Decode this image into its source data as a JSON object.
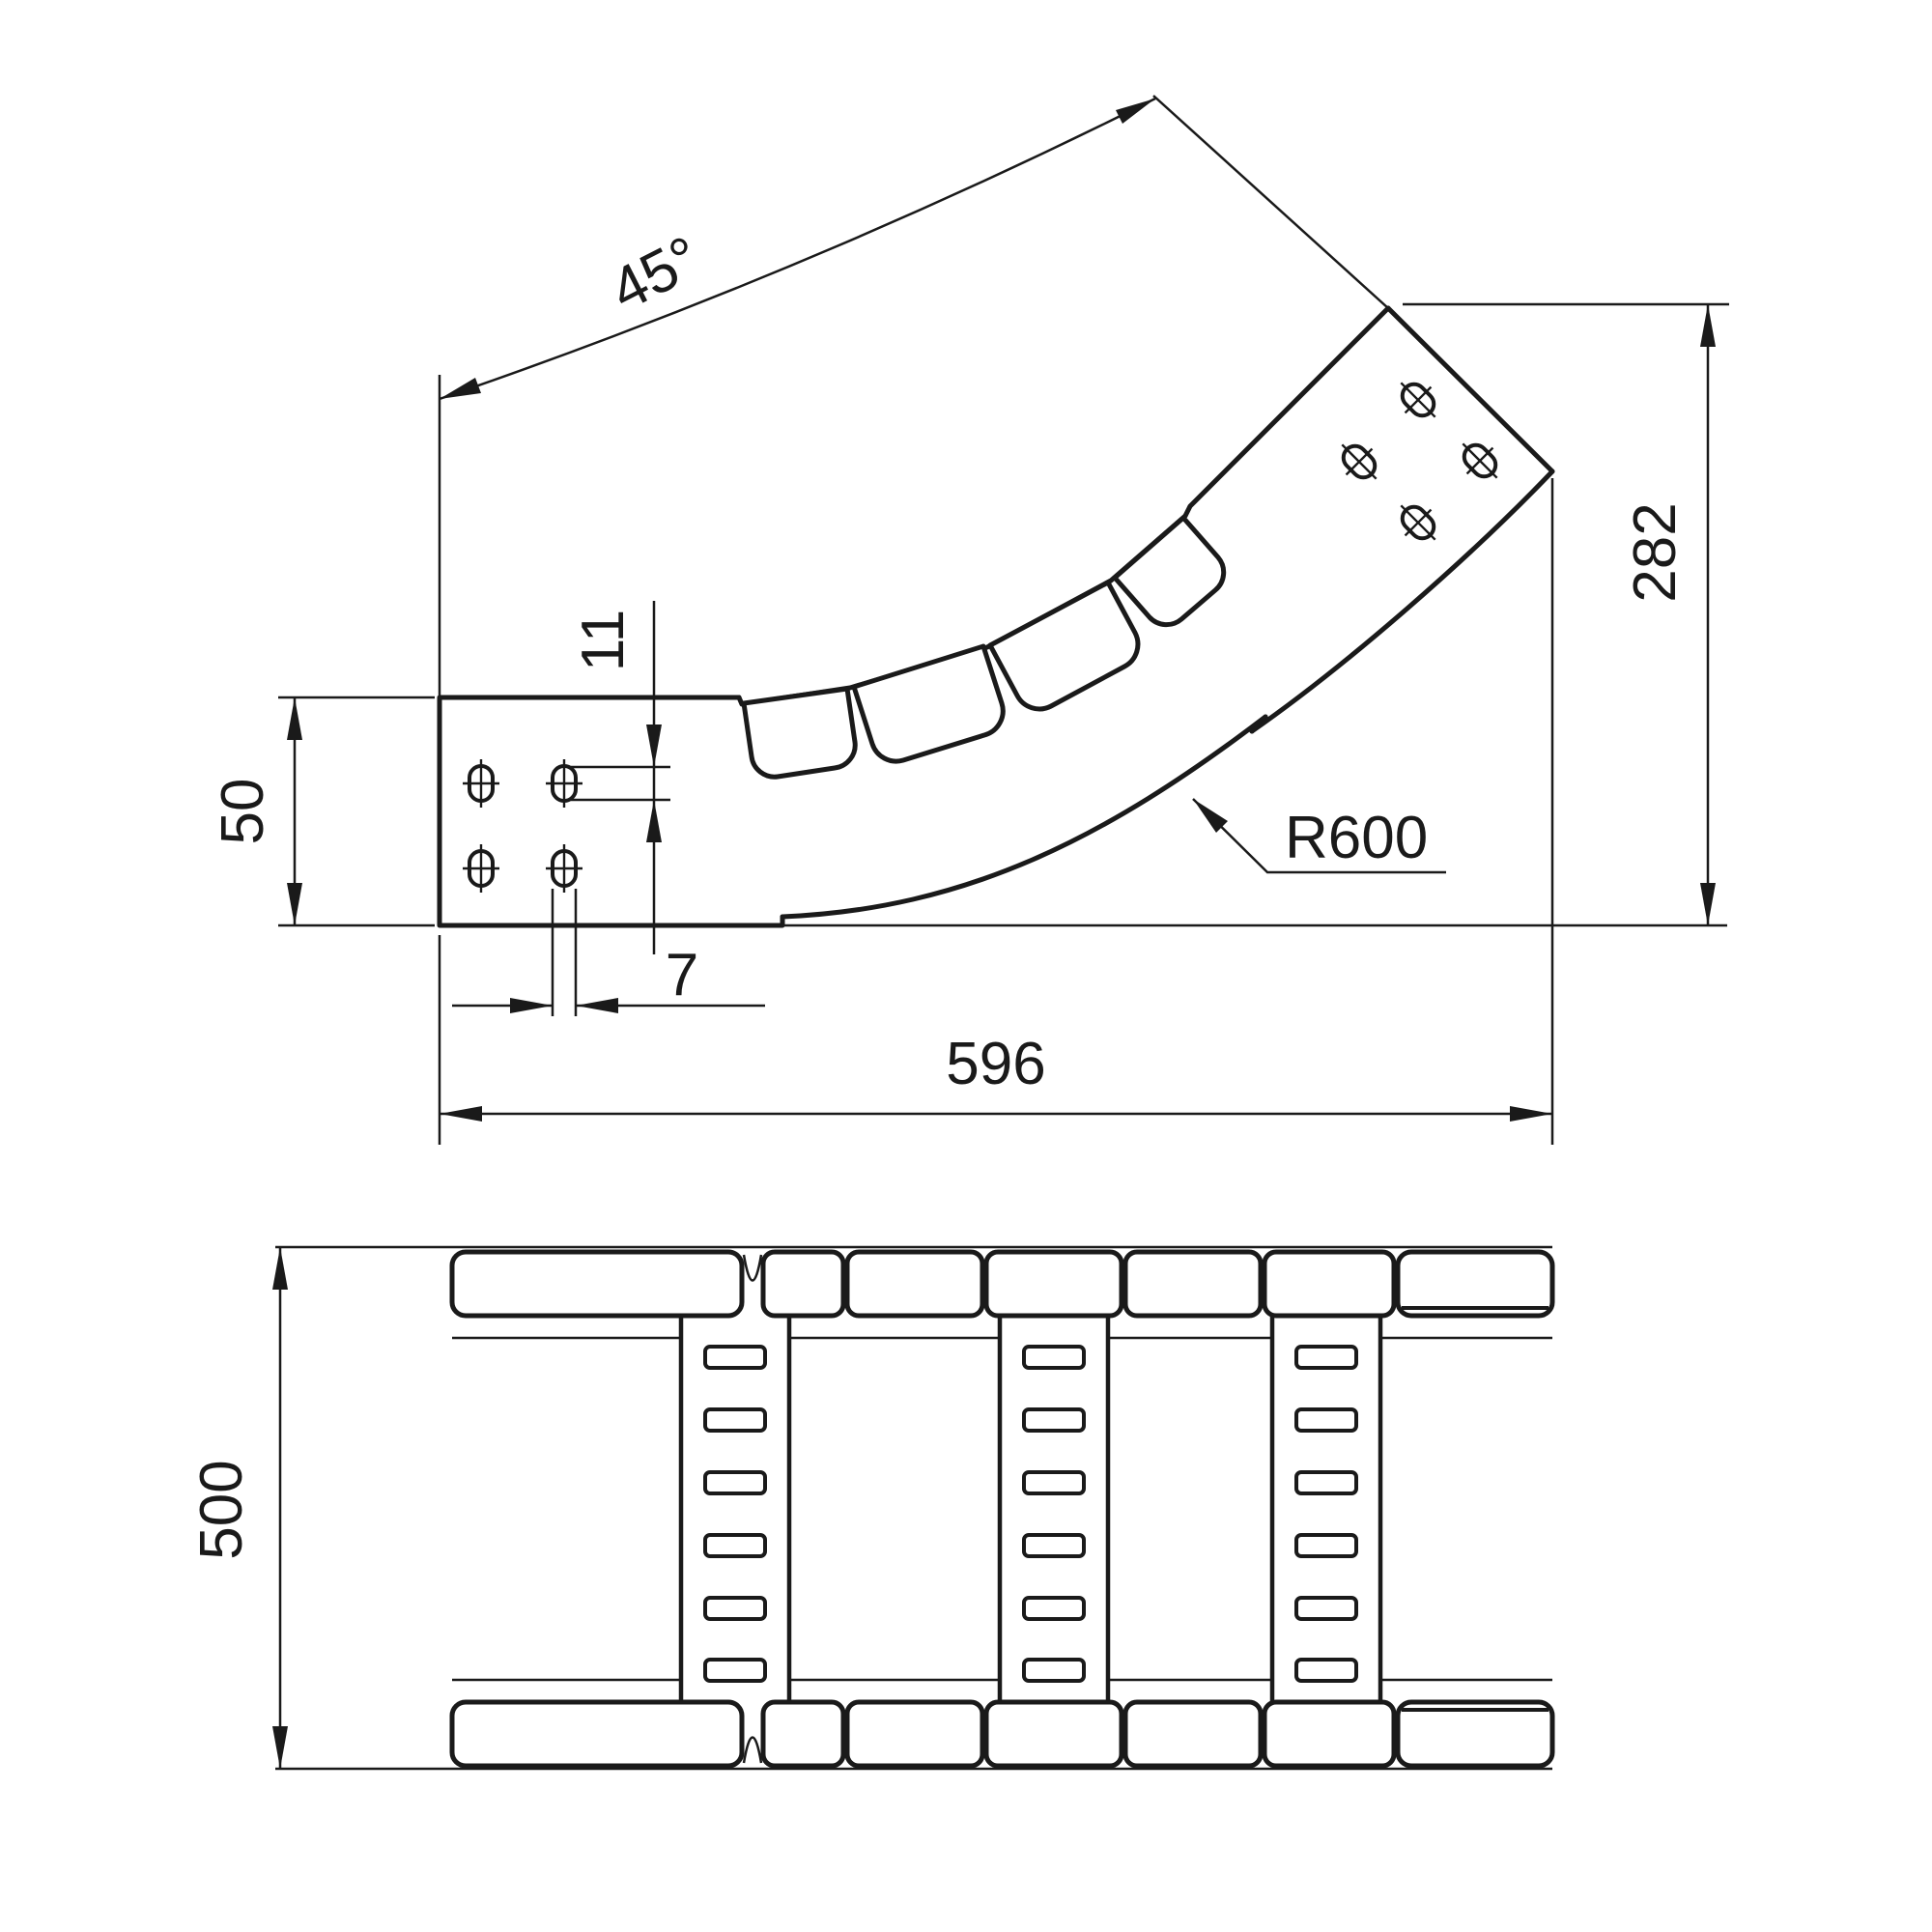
{
  "ink": "#1a1a1a",
  "background": "#ffffff",
  "dims": {
    "angle": "45°",
    "drop_height": "282",
    "rail_height": "50",
    "slot_length": "11",
    "slot_width": "7",
    "overall_length": "596",
    "bend_radius": "R600",
    "overall_width": "500"
  }
}
